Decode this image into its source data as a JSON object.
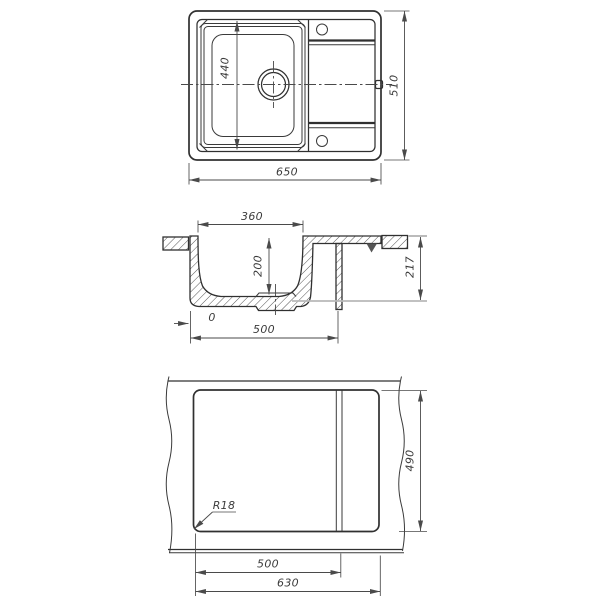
{
  "drawing": {
    "type": "sink-installation-technical-drawing",
    "colors": {
      "line": "#303030",
      "dim": "#4a4a4a",
      "text": "#3b3b3b",
      "light_extension": "#b8b8b8",
      "bg": "#ffffff"
    },
    "top_view": {
      "overall_width": "650",
      "overall_depth": "510",
      "bowl_length": "440"
    },
    "section_view": {
      "bowl_top_width": "360",
      "bowl_depth": "200",
      "overall_height": "217",
      "underside_width": "500",
      "edge_offset": "0"
    },
    "bottom_view": {
      "cutout_depth": "490",
      "ledge_offset": "500",
      "cutout_width": "630",
      "corner_radius_label": "R18"
    }
  }
}
